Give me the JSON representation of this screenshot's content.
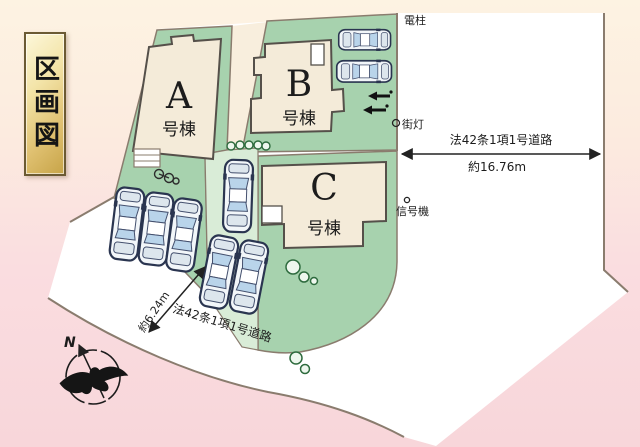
{
  "title": {
    "text": "区画図"
  },
  "buildings": {
    "a": {
      "letter": "A",
      "suffix": "号棟"
    },
    "b": {
      "letter": "B",
      "suffix": "号棟"
    },
    "c": {
      "letter": "C",
      "suffix": "号棟"
    }
  },
  "roads": {
    "east": {
      "name": "法42条1項1号道路",
      "width": "約16.76m"
    },
    "south": {
      "name": "法42条1項1号道路",
      "width": "約6.24m"
    }
  },
  "markers": {
    "utility_pole": "電柱",
    "street_light": "街灯",
    "traffic_signal": "信号機"
  },
  "compass": {
    "north": "N"
  },
  "colors": {
    "plot_green": "#a7d2ae",
    "path_green": "#d9ecd7",
    "building_fill": "#f4ebd9",
    "road_white": "#ffffff",
    "outline": "#8a7c6e",
    "bg_top": "#fdf3e2",
    "bg_bottom": "#f8d6da",
    "title_gold": "#dfc070"
  }
}
